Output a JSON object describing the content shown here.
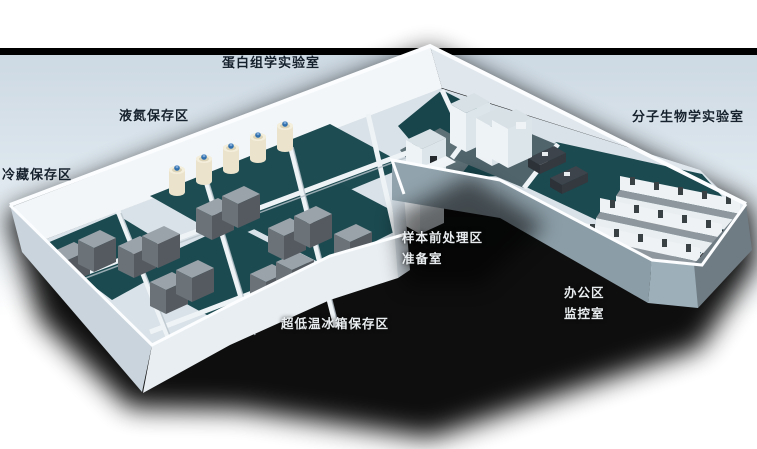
{
  "scene": {
    "description": "3D rendered floor plan of a biobank / laboratory facility",
    "colors": {
      "background": "#ffffff",
      "top_band": "#000000",
      "sky": "#d3dee8",
      "floor_teal": "#1b4a50",
      "wall_white": "#eef3f6",
      "wall_shaded": "#8fa1ab",
      "shadow": "#000000",
      "label_dark": "#15212d",
      "label_light": "#e9edef",
      "tank_body": "#ebe3cc",
      "tank_cap": "#2f6fae",
      "freezer_gray": "#6b7379",
      "bench_top": "#8f979e",
      "bench_beige": "#e5decb",
      "desk_dark": "#3d444b"
    }
  },
  "rooms": {
    "proteomics": {
      "label": "蛋白组学实验室"
    },
    "liquid_nitrogen": {
      "label": "液氮保存区"
    },
    "cold_storage": {
      "label": "冷藏保存区"
    },
    "molecular_biology": {
      "label": "分子生物学实验室"
    },
    "sample_pretreatment": {
      "label": "样本前处理区"
    },
    "preparation": {
      "label": "准备室"
    },
    "office": {
      "label": "办公区"
    },
    "monitoring": {
      "label": "监控室"
    },
    "ult_freezer": {
      "label": "超低温冰箱保存区"
    }
  }
}
